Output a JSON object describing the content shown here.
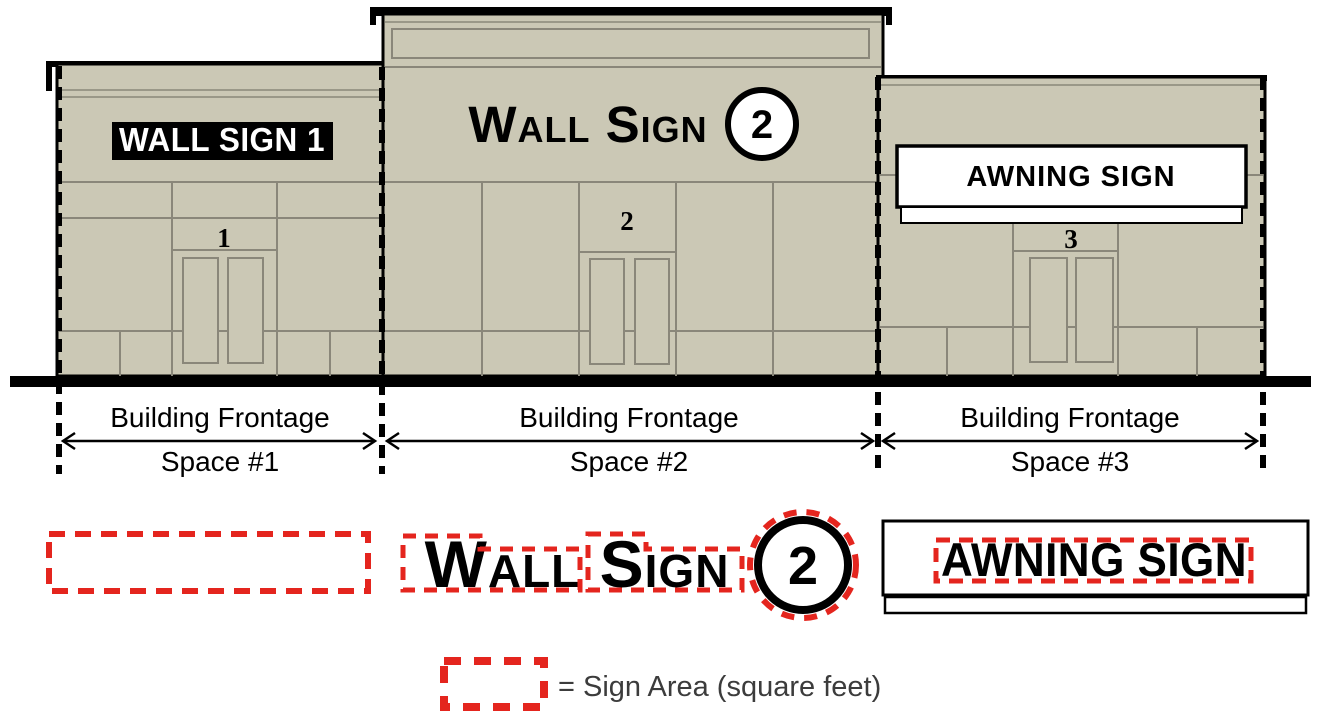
{
  "colors": {
    "facade_tan": "#cbc8b5",
    "joint_gray": "#8a877a",
    "outline_black": "#000000",
    "sign_area_red": "#e4251e",
    "legend_text_gray": "#3c3c3c",
    "sign_white": "#ffffff"
  },
  "elevation": {
    "wall_sign_1": {
      "label": "WALL SIGN 1"
    },
    "wall_sign_2": {
      "label": "Wall Sign",
      "badge": "2"
    },
    "awning_sign": {
      "label": "AWNING SIGN"
    },
    "doors": [
      {
        "number": "1"
      },
      {
        "number": "2"
      },
      {
        "number": "3"
      }
    ]
  },
  "frontage_labels": [
    {
      "frontage": "Building Frontage",
      "space": "Space #1"
    },
    {
      "frontage": "Building Frontage",
      "space": "Space #2"
    },
    {
      "frontage": "Building Frontage",
      "space": "Space #3"
    }
  ],
  "sign_area_examples": {
    "wall_sign_1": {
      "label": "WALL SIGN 1"
    },
    "wall_sign_2": {
      "label": "Wall Sign",
      "badge": "2"
    },
    "awning_sign": {
      "label": "AWNING SIGN"
    }
  },
  "legend": {
    "label": "= Sign Area (square feet)"
  }
}
